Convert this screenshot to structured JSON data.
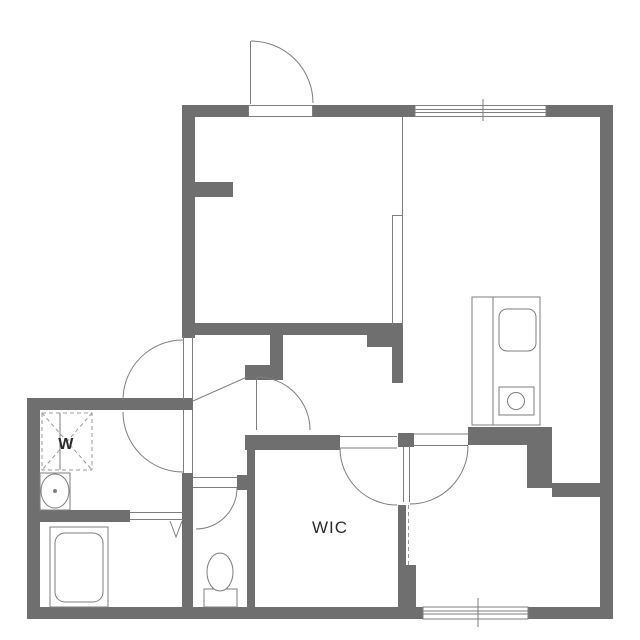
{
  "labels": {
    "walk_in_closet": "WIC",
    "washer": "W"
  },
  "colors": {
    "wall": "#6f6f6f",
    "line": "#7e7e7e",
    "dash": "#9a9a9a",
    "text": "#2b2b2b",
    "background": "#ffffff",
    "fixture_fill": "#ffffff"
  }
}
